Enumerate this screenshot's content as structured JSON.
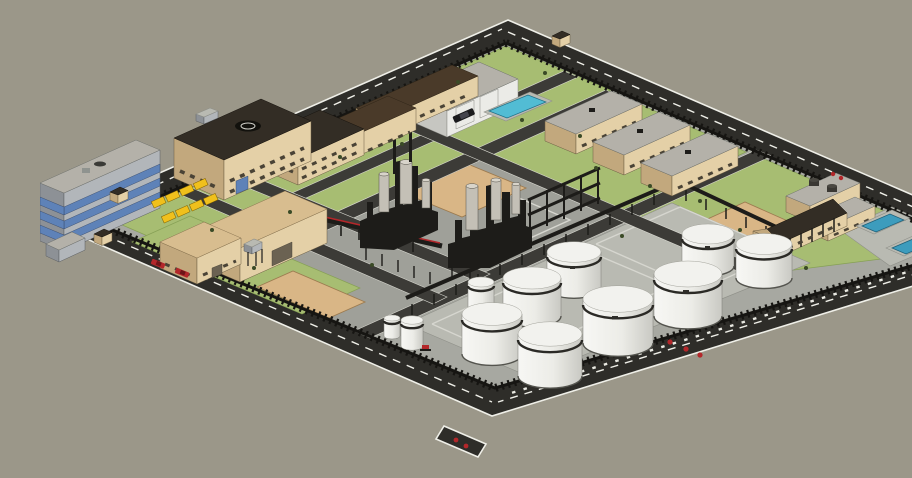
{
  "meta": {
    "description": "Aerial 3D model render of a fenced industrial plant / refinery complex",
    "render_style": "SketchUp-like shaded 3D model, isometric-perspective bird's-eye view",
    "visible_text": []
  },
  "colors": {
    "bg": "#9b9789",
    "road": "#2e2d29",
    "road-line": "#efefe8",
    "asphalt": "#3c3b37",
    "fence": "#161512",
    "interior": "#a7a8a1",
    "grass": "#a7bd72",
    "grass-edge": "#86a055",
    "concrete": "#9fa099",
    "concrete-light": "#b9bab2",
    "sand": "#d9b686",
    "sand-edge": "#9c7b50",
    "tan-lit": "#e4d0a7",
    "tan-shade": "#c2a87d",
    "tan-roof": "#d8bd8f",
    "roof-dark": "#332d25",
    "roof-brown": "#4a3a29",
    "roof-gray": "#b4b1a9",
    "gray-lit": "#b2b6ba",
    "gray-shade": "#8d9196",
    "white-lit": "#ebebe7",
    "white-shade": "#c6c6c1",
    "window-blue": "#5e82b8",
    "steel": "#1d1c19",
    "cylinder": "#c4c0b6",
    "pool": "#52bcd4",
    "basin": "#3d9cbd",
    "yellow": "#f0c01c",
    "red": "#b3272a",
    "bush": "#3a4a26"
  },
  "scene": {
    "site": {
      "perimeter": "ring road with dashed lane markings around a dark spiked security wall",
      "entrance": "driveway stub at the south corner of the ring road"
    },
    "buildings": [
      {
        "name": "office-tower",
        "walls": "gray",
        "windows": "blue glass bands",
        "roof": "flat gray"
      },
      {
        "name": "helipad-building",
        "walls": "tan",
        "roof": "flat dark with helipad circle"
      },
      {
        "name": "admin-building",
        "walls": "tan",
        "roof": "dark hipped"
      },
      {
        "name": "warehouse-shed-1",
        "walls": "tan",
        "roof": "dark brown"
      },
      {
        "name": "warehouse-shed-2",
        "walls": "tan",
        "roof": "dark brown"
      },
      {
        "name": "garage-building",
        "walls": "white",
        "doors": "two white roll-up doors",
        "roof": "gray"
      },
      {
        "name": "barracks-1",
        "walls": "tan",
        "roof": "flat gray"
      },
      {
        "name": "barracks-2",
        "walls": "tan",
        "roof": "flat gray"
      },
      {
        "name": "barracks-3",
        "walls": "tan",
        "roof": "flat gray"
      },
      {
        "name": "utility-building-1",
        "walls": "tan",
        "roof": "flat with two dark roof tanks"
      },
      {
        "name": "utility-building-2",
        "walls": "tan",
        "roof": "flat gray"
      },
      {
        "name": "gable-house",
        "walls": "tan",
        "roof": "dark gable with porch posts"
      },
      {
        "name": "warehouse-left-annex",
        "walls": "tan",
        "roof": "tan"
      },
      {
        "name": "warehouse-left-main",
        "walls": "tan",
        "roof": "tan hip",
        "extras": "elevated water tank"
      },
      {
        "name": "small-gray-shed",
        "walls": "gray",
        "roof": "gray"
      }
    ],
    "tank_farm": {
      "large_tanks": 8,
      "small_tanks": 3,
      "finish": "white with dark rim band",
      "pad": "gray bunded concrete"
    },
    "process_units": {
      "column_clusters": 2,
      "steel_frame_structures": 1,
      "pipe_racks": 3,
      "red_pipe_runs": 2,
      "tall_stacks": 2,
      "gray_vessels": 6
    },
    "water_features": {
      "swimming_pool": 1,
      "treatment_basins": 2
    },
    "ground_patches": {
      "sand_pads": 3,
      "lawns": 5,
      "concrete_pads": 4
    },
    "vehicles": {
      "black_car": 1,
      "red_cars": 2,
      "red_road_units": 3
    },
    "parking_canopies": 8,
    "guard_booths": 3,
    "bushes": 16
  }
}
